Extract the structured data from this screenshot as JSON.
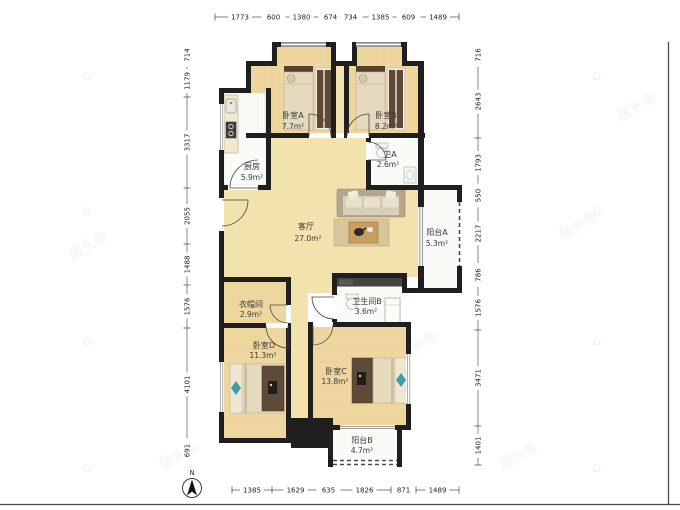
{
  "meta": {
    "compass_label": "N"
  },
  "rooms": [
    {
      "id": "bedroom-a",
      "name": "卧室A",
      "area": "7.7m²"
    },
    {
      "id": "bedroom-b",
      "name": "卧室B",
      "area": "8.2m²"
    },
    {
      "id": "bath-a",
      "name": "卫A",
      "area": "2.6m²"
    },
    {
      "id": "kitchen",
      "name": "厨房",
      "area": "5.9m²"
    },
    {
      "id": "living-room",
      "name": "客厅",
      "area": "27.0m²"
    },
    {
      "id": "balcony-a",
      "name": "阳台A",
      "area": "5.3m²"
    },
    {
      "id": "cloakroom",
      "name": "衣帽间",
      "area": "2.9m²"
    },
    {
      "id": "bath-b",
      "name": "卫生间B",
      "area": "3.6m²"
    },
    {
      "id": "bedroom-d",
      "name": "卧室D",
      "area": "11.3m²"
    },
    {
      "id": "bedroom-c",
      "name": "卧室C",
      "area": "13.8m²"
    },
    {
      "id": "balcony-b",
      "name": "阳台B",
      "area": "4.7m²"
    }
  ],
  "dimensions_mm": {
    "top": [
      "1773",
      "600",
      "1380",
      "674",
      "734",
      "1385",
      "609",
      "1489"
    ],
    "bottom": [
      "1385",
      "1629",
      "635",
      "1826",
      "871",
      "1489"
    ],
    "left": [
      "714",
      "1179",
      "3317",
      "2055",
      "1488",
      "1576",
      "4101",
      "691"
    ],
    "right": [
      "716",
      "2643",
      "1793",
      "550",
      "2217",
      "786",
      "1576",
      "3471",
      "1401"
    ]
  },
  "watermark": {
    "text": "居头条"
  }
}
